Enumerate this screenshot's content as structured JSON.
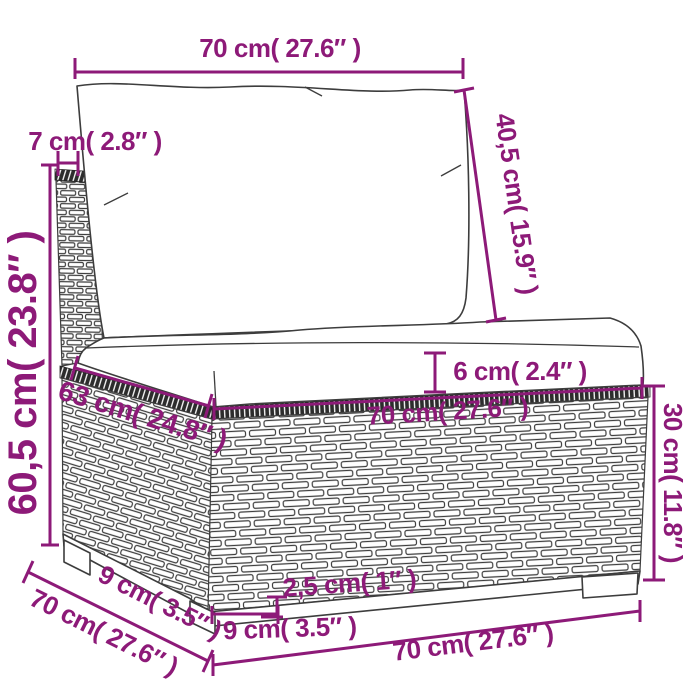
{
  "diagram_title": "sofa-section-dimension-diagram",
  "accent_color": "#8d1a78",
  "labels": {
    "top_width": "70 cm( 27.6″ )",
    "back_thickness": "7 cm( 2.8″ )",
    "back_cushion_height": "40,5 cm( 15.9″ )",
    "total_height": "60,5 cm( 23.8″ )",
    "seat_cushion_thickness": "6 cm( 2.4″ )",
    "seat_depth": "63 cm( 24.8″ )",
    "seat_front_width": "70 cm( 27.6″ )",
    "base_height": "30 cm( 11.8″ )",
    "side_leg_inset": "9 cm( 3.5″ )",
    "total_depth": "70 cm( 27.6″ )",
    "leg_height": "2,5 cm( 1″ )",
    "leg_width": "9 cm( 3.5″ )",
    "bottom_width": "70 cm( 27.6″ )"
  }
}
